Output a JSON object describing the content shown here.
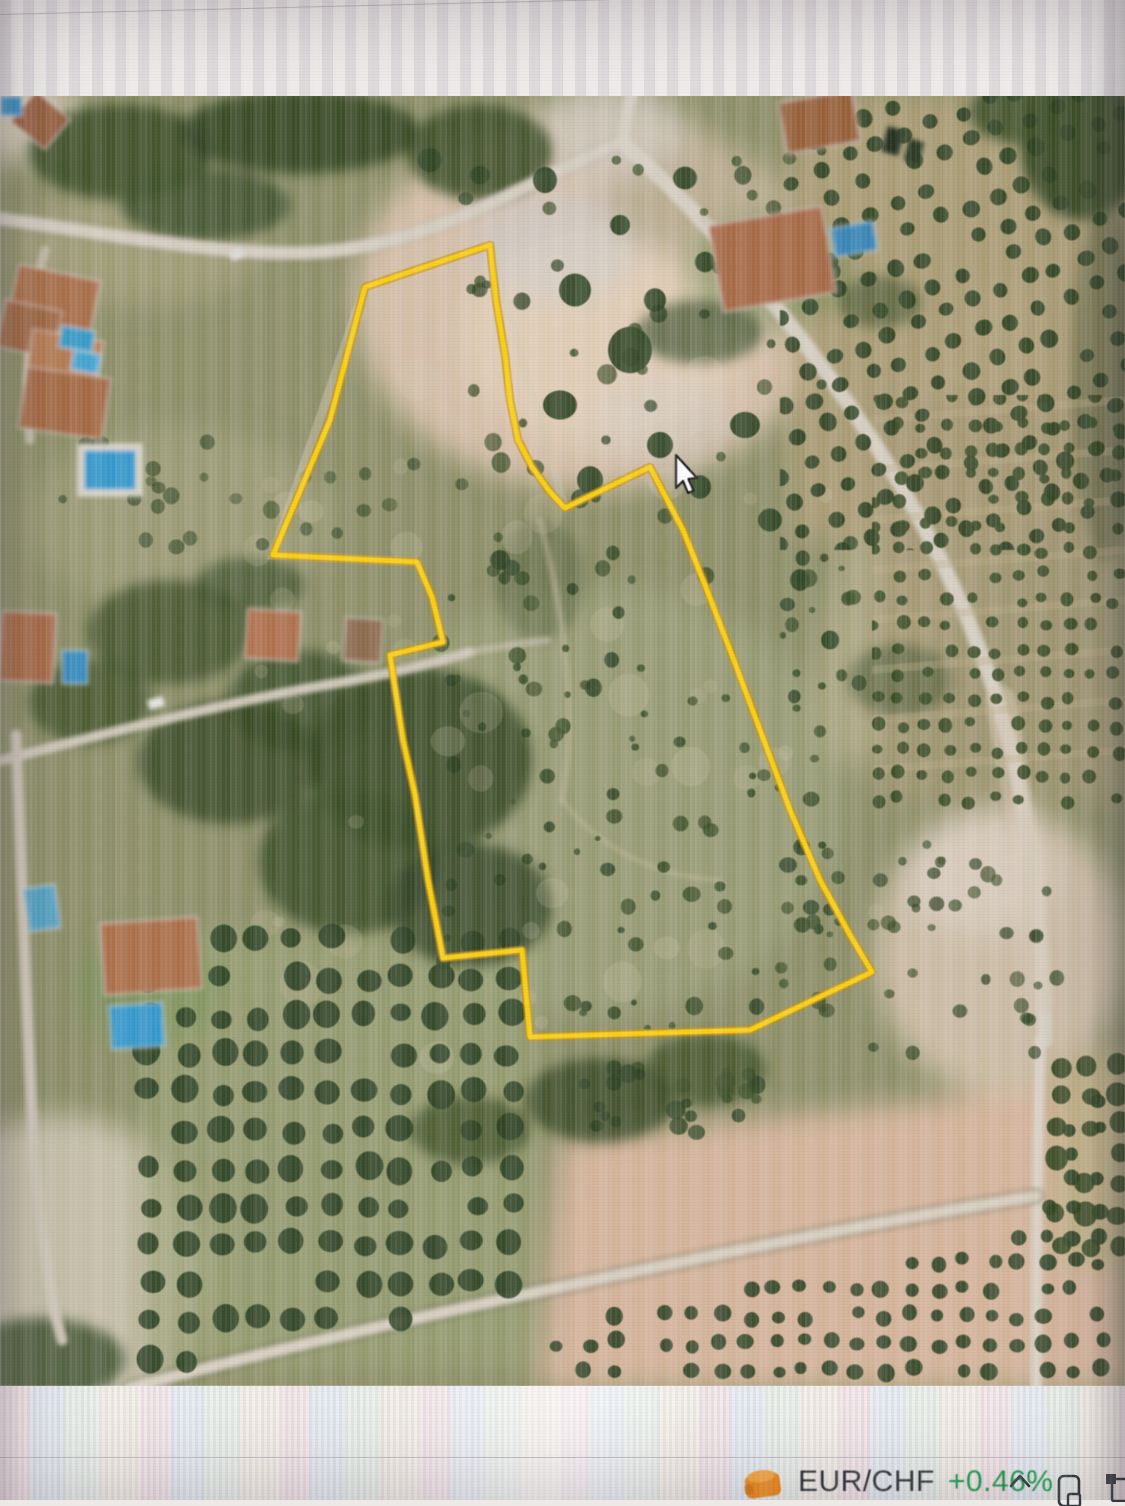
{
  "map": {
    "parcel_boundary": {
      "color": "#ffd200",
      "halo_color": "#d29000",
      "points": "365,287 490,245 496,300 505,355 510,400 518,440 532,467 550,492 565,508 650,467 683,530 705,585 730,650 760,730 790,810 820,880 850,935 872,972 750,1030 530,1037 522,950 443,958 428,880 415,795 403,740 390,655 443,642 432,597 417,562 273,555 330,420"
    },
    "cursor": {
      "x": 676,
      "y": 455
    }
  },
  "taskbar": {
    "ticker": {
      "icon": "stocks-widget-icon",
      "symbol": "EUR/CHF",
      "change": "+0.46%",
      "symbol_color": "#2e3338",
      "change_color": "#189a4a"
    },
    "tray_icons": [
      "chevron-up-icon",
      "phone-link-icon",
      "monitor-icon"
    ]
  }
}
